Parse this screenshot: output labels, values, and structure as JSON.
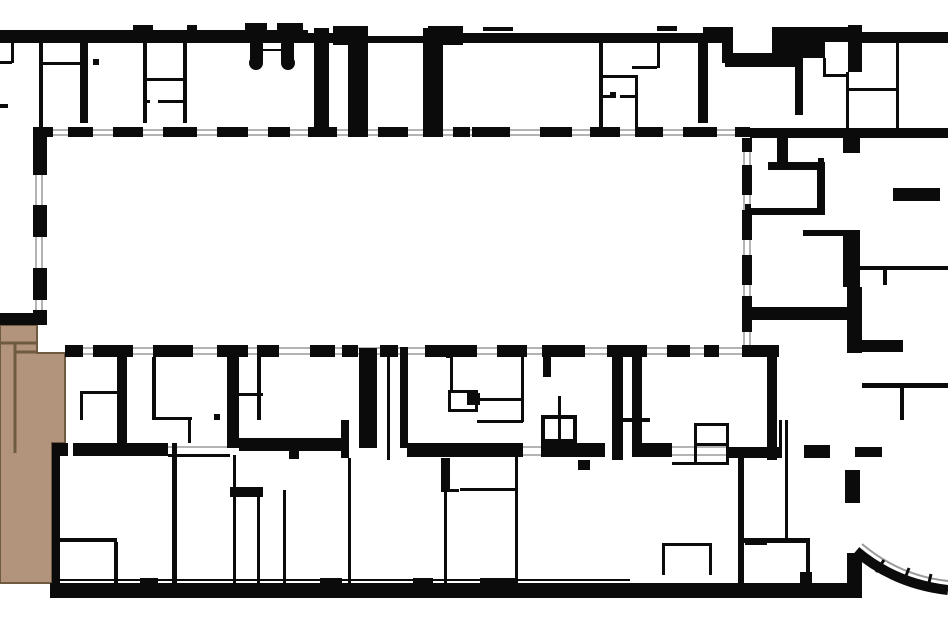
{
  "meta": {
    "type": "architectural-floor-plan",
    "description": "building floor plan with one highlighted unit"
  },
  "canvas": {
    "w": 948,
    "h": 632,
    "bg": "#ffffff"
  },
  "colors": {
    "wall": "#0b0b0b",
    "window_line": "#9a9a9a",
    "highlight_fill": "#b2937b",
    "highlight_stroke": "#6f5b41"
  },
  "highlight_unit": {
    "polygon": [
      [
        0,
        325
      ],
      [
        37,
        325
      ],
      [
        37,
        353
      ],
      [
        65,
        353
      ],
      [
        65,
        443
      ],
      [
        52,
        443
      ],
      [
        52,
        583
      ],
      [
        0,
        583
      ]
    ],
    "interior_lines": [
      [
        15,
        343,
        15,
        453
      ],
      [
        0,
        343,
        37,
        343
      ],
      [
        15,
        352,
        37,
        352
      ]
    ]
  },
  "walls": [
    [
      0,
      30,
      308,
      13
    ],
    [
      308,
      33,
      25,
      10
    ],
    [
      333,
      26,
      35,
      19
    ],
    [
      368,
      36,
      60,
      7
    ],
    [
      428,
      26,
      35,
      19
    ],
    [
      463,
      33,
      240,
      10
    ],
    [
      703,
      27,
      30,
      16
    ],
    [
      722,
      40,
      11,
      23
    ],
    [
      725,
      53,
      52,
      14
    ],
    [
      772,
      27,
      26,
      40
    ],
    [
      795,
      27,
      53,
      15
    ],
    [
      848,
      25,
      14,
      47
    ],
    [
      862,
      32,
      86,
      11
    ],
    [
      133,
      25,
      20,
      5
    ],
    [
      187,
      25,
      10,
      5
    ],
    [
      245,
      23,
      22,
      7
    ],
    [
      277,
      23,
      26,
      7
    ],
    [
      483,
      27,
      30,
      4
    ],
    [
      657,
      26,
      20,
      5
    ],
    [
      250,
      41,
      13,
      21
    ],
    [
      281,
      41,
      13,
      21
    ],
    [
      39,
      41,
      4,
      87
    ],
    [
      80,
      41,
      8,
      82
    ],
    [
      143,
      41,
      4,
      82
    ],
    [
      183,
      41,
      4,
      82
    ],
    [
      43,
      62,
      37,
      3
    ],
    [
      143,
      78,
      44,
      3
    ],
    [
      143,
      100,
      7,
      3
    ],
    [
      158,
      100,
      29,
      3
    ],
    [
      314,
      28,
      15,
      105
    ],
    [
      348,
      28,
      20,
      105
    ],
    [
      423,
      28,
      20,
      105
    ],
    [
      599,
      43,
      4,
      85
    ],
    [
      603,
      75,
      32,
      3
    ],
    [
      603,
      95,
      8,
      3
    ],
    [
      620,
      95,
      15,
      3
    ],
    [
      635,
      75,
      3,
      53
    ],
    [
      698,
      40,
      10,
      83
    ],
    [
      657,
      43,
      3,
      25
    ],
    [
      632,
      66,
      25,
      3
    ],
    [
      795,
      42,
      8,
      73
    ],
    [
      803,
      42,
      22,
      16
    ],
    [
      823,
      58,
      3,
      19
    ],
    [
      823,
      74,
      25,
      3
    ],
    [
      846,
      72,
      3,
      56
    ],
    [
      846,
      88,
      51,
      3
    ],
    [
      896,
      43,
      3,
      85
    ],
    [
      11,
      41,
      3,
      22
    ],
    [
      0,
      61,
      12,
      3
    ],
    [
      0,
      104,
      8,
      4
    ],
    [
      750,
      128,
      198,
      10
    ],
    [
      742,
      307,
      106,
      13
    ],
    [
      843,
      138,
      17,
      15
    ],
    [
      768,
      162,
      57,
      8
    ],
    [
      817,
      170,
      8,
      45
    ],
    [
      745,
      208,
      80,
      7
    ],
    [
      777,
      138,
      11,
      25
    ],
    [
      893,
      188,
      47,
      13
    ],
    [
      803,
      230,
      40,
      6
    ],
    [
      843,
      230,
      17,
      57
    ],
    [
      847,
      287,
      15,
      66
    ],
    [
      850,
      340,
      53,
      12
    ],
    [
      860,
      266,
      88,
      4
    ],
    [
      883,
      270,
      4,
      15
    ],
    [
      862,
      383,
      86,
      5
    ],
    [
      900,
      388,
      4,
      32
    ],
    [
      767,
      345,
      10,
      115
    ],
    [
      117,
      355,
      10,
      100
    ],
    [
      227,
      352,
      12,
      96
    ],
    [
      359,
      348,
      18,
      100
    ],
    [
      387,
      355,
      3,
      105
    ],
    [
      400,
      347,
      8,
      101
    ],
    [
      612,
      347,
      11,
      113
    ],
    [
      632,
      352,
      10,
      105
    ],
    [
      52,
      443,
      16,
      13
    ],
    [
      73,
      443,
      95,
      13
    ],
    [
      168,
      454,
      62,
      3
    ],
    [
      239,
      438,
      103,
      13
    ],
    [
      289,
      451,
      10,
      8
    ],
    [
      407,
      443,
      116,
      14
    ],
    [
      541,
      443,
      64,
      14
    ],
    [
      632,
      443,
      40,
      14
    ],
    [
      672,
      462,
      22,
      3
    ],
    [
      729,
      447,
      50,
      11
    ],
    [
      804,
      445,
      26,
      13
    ],
    [
      855,
      447,
      27,
      10
    ],
    [
      152,
      357,
      4,
      61
    ],
    [
      152,
      417,
      40,
      3
    ],
    [
      188,
      420,
      3,
      23
    ],
    [
      80,
      391,
      37,
      3
    ],
    [
      80,
      394,
      3,
      26
    ],
    [
      257,
      352,
      4,
      68
    ],
    [
      238,
      393,
      25,
      3
    ],
    [
      448,
      390,
      30,
      3
    ],
    [
      448,
      393,
      3,
      19
    ],
    [
      475,
      393,
      3,
      19
    ],
    [
      448,
      409,
      30,
      3
    ],
    [
      467,
      393,
      13,
      12
    ],
    [
      450,
      357,
      3,
      33
    ],
    [
      521,
      357,
      3,
      65
    ],
    [
      477,
      398,
      46,
      3
    ],
    [
      477,
      420,
      46,
      3
    ],
    [
      543,
      357,
      8,
      20
    ],
    [
      558,
      396,
      3,
      47
    ],
    [
      541,
      415,
      36,
      4
    ],
    [
      541,
      419,
      4,
      24
    ],
    [
      573,
      419,
      4,
      24
    ],
    [
      541,
      439,
      36,
      4
    ],
    [
      623,
      418,
      27,
      4
    ],
    [
      172,
      443,
      5,
      140
    ],
    [
      58,
      538,
      59,
      4
    ],
    [
      114,
      542,
      4,
      41
    ],
    [
      233,
      455,
      3,
      128
    ],
    [
      230,
      487,
      33,
      10
    ],
    [
      257,
      497,
      3,
      86
    ],
    [
      283,
      490,
      3,
      93
    ],
    [
      341,
      420,
      8,
      38
    ],
    [
      348,
      458,
      3,
      125
    ],
    [
      441,
      458,
      9,
      34
    ],
    [
      444,
      492,
      3,
      91
    ],
    [
      441,
      489,
      18,
      3
    ],
    [
      515,
      457,
      3,
      123
    ],
    [
      460,
      488,
      55,
      3
    ],
    [
      578,
      460,
      12,
      10
    ],
    [
      694,
      423,
      35,
      3
    ],
    [
      694,
      426,
      3,
      39
    ],
    [
      726,
      426,
      3,
      39
    ],
    [
      694,
      443,
      35,
      3
    ],
    [
      694,
      462,
      35,
      3
    ],
    [
      779,
      420,
      3,
      38
    ],
    [
      785,
      420,
      3,
      120
    ],
    [
      738,
      458,
      6,
      127
    ],
    [
      742,
      538,
      68,
      5
    ],
    [
      745,
      538,
      22,
      7
    ],
    [
      806,
      541,
      4,
      34
    ],
    [
      800,
      572,
      12,
      11
    ],
    [
      662,
      543,
      50,
      3
    ],
    [
      662,
      546,
      3,
      29
    ],
    [
      709,
      546,
      3,
      29
    ],
    [
      845,
      470,
      15,
      33
    ],
    [
      140,
      578,
      18,
      5
    ],
    [
      320,
      578,
      22,
      5
    ],
    [
      413,
      578,
      20,
      5
    ],
    [
      480,
      578,
      38,
      5
    ],
    [
      50,
      583,
      812,
      15
    ],
    [
      847,
      553,
      15,
      45
    ],
    [
      0,
      313,
      43,
      12
    ],
    [
      52,
      455,
      8,
      128
    ]
  ],
  "window_runs": {
    "top": {
      "dash_y": 127,
      "dash_h": 10,
      "dashes": [
        [
          33,
          20
        ],
        [
          68,
          25
        ],
        [
          113,
          30
        ],
        [
          163,
          34
        ],
        [
          217,
          31
        ],
        [
          268,
          22
        ],
        [
          308,
          29
        ],
        [
          348,
          20
        ],
        [
          378,
          30
        ],
        [
          423,
          20
        ],
        [
          453,
          17
        ],
        [
          472,
          38
        ],
        [
          540,
          32
        ],
        [
          590,
          30
        ],
        [
          635,
          28
        ],
        [
          683,
          34
        ],
        [
          735,
          15
        ]
      ]
    },
    "bottom": {
      "dash_y": 345,
      "dash_h": 12,
      "dashes": [
        [
          65,
          18
        ],
        [
          93,
          40
        ],
        [
          153,
          40
        ],
        [
          217,
          31
        ],
        [
          257,
          22
        ],
        [
          310,
          25
        ],
        [
          342,
          16
        ],
        [
          380,
          18
        ],
        [
          425,
          52
        ],
        [
          497,
          30
        ],
        [
          542,
          43
        ],
        [
          607,
          40
        ],
        [
          667,
          23
        ],
        [
          704,
          15
        ],
        [
          742,
          37
        ]
      ]
    },
    "left": {
      "dash_x": 33,
      "dash_w": 14,
      "dashes": [
        [
          128,
          14
        ],
        [
          140,
          35
        ],
        [
          205,
          32
        ],
        [
          268,
          32
        ],
        [
          310,
          15
        ]
      ]
    },
    "right": {
      "dash_x": 742,
      "dash_w": 10,
      "dashes": [
        [
          138,
          14
        ],
        [
          165,
          30
        ],
        [
          210,
          30
        ],
        [
          255,
          30
        ],
        [
          296,
          24
        ],
        [
          320,
          12
        ]
      ]
    }
  },
  "lines": [
    {
      "x1": 33,
      "y1": 130,
      "x2": 750,
      "y2": 130,
      "w": 1.5,
      "c": "win"
    },
    {
      "x1": 33,
      "y1": 135,
      "x2": 750,
      "y2": 135,
      "w": 1.5,
      "c": "win"
    },
    {
      "x1": 36,
      "y1": 128,
      "x2": 36,
      "y2": 325,
      "w": 1.5,
      "c": "win"
    },
    {
      "x1": 42,
      "y1": 128,
      "x2": 42,
      "y2": 325,
      "w": 1.5,
      "c": "win"
    },
    {
      "x1": 65,
      "y1": 348,
      "x2": 779,
      "y2": 348,
      "w": 1.5,
      "c": "win"
    },
    {
      "x1": 65,
      "y1": 354,
      "x2": 779,
      "y2": 354,
      "w": 1.5,
      "c": "win"
    },
    {
      "x1": 744,
      "y1": 138,
      "x2": 744,
      "y2": 345,
      "w": 1.5,
      "c": "win"
    },
    {
      "x1": 750,
      "y1": 138,
      "x2": 750,
      "y2": 345,
      "w": 1.5,
      "c": "win"
    },
    {
      "x1": 168,
      "y1": 447,
      "x2": 230,
      "y2": 447,
      "w": 1.5,
      "c": "win"
    },
    {
      "x1": 168,
      "y1": 455,
      "x2": 230,
      "y2": 455,
      "w": 1.5,
      "c": "win"
    },
    {
      "x1": 523,
      "y1": 447,
      "x2": 541,
      "y2": 447,
      "w": 1.5,
      "c": "win"
    },
    {
      "x1": 523,
      "y1": 455,
      "x2": 541,
      "y2": 455,
      "w": 1.5,
      "c": "win"
    },
    {
      "x1": 672,
      "y1": 447,
      "x2": 729,
      "y2": 447,
      "w": 1.5,
      "c": "win"
    },
    {
      "x1": 672,
      "y1": 455,
      "x2": 729,
      "y2": 455,
      "w": 1.5,
      "c": "win"
    },
    {
      "x1": 263,
      "y1": 50,
      "x2": 281,
      "y2": 50,
      "w": 2,
      "c": "wall"
    },
    {
      "x1": 50,
      "y1": 580,
      "x2": 630,
      "y2": 580,
      "w": 2,
      "c": "wall"
    }
  ],
  "entrance_columns": [
    [
      256,
      63,
      7
    ],
    [
      288,
      63,
      7
    ]
  ],
  "bay_arc": {
    "outer_path": "M 856 551 Q 895 584 948 590",
    "outer_width": 10,
    "inner_path": "M 862 544 Q 900 576 948 581",
    "inner_width": 2,
    "ticks": [
      [
        876,
        572,
        884,
        560
      ],
      [
        904,
        581,
        909,
        568
      ],
      [
        928,
        587,
        931,
        574
      ]
    ]
  },
  "door_ticks": [
    [
      93,
      59
    ],
    [
      610,
      92
    ],
    [
      214,
      414
    ],
    [
      745,
      204
    ],
    [
      818,
      158
    ],
    [
      446,
      352
    ]
  ]
}
